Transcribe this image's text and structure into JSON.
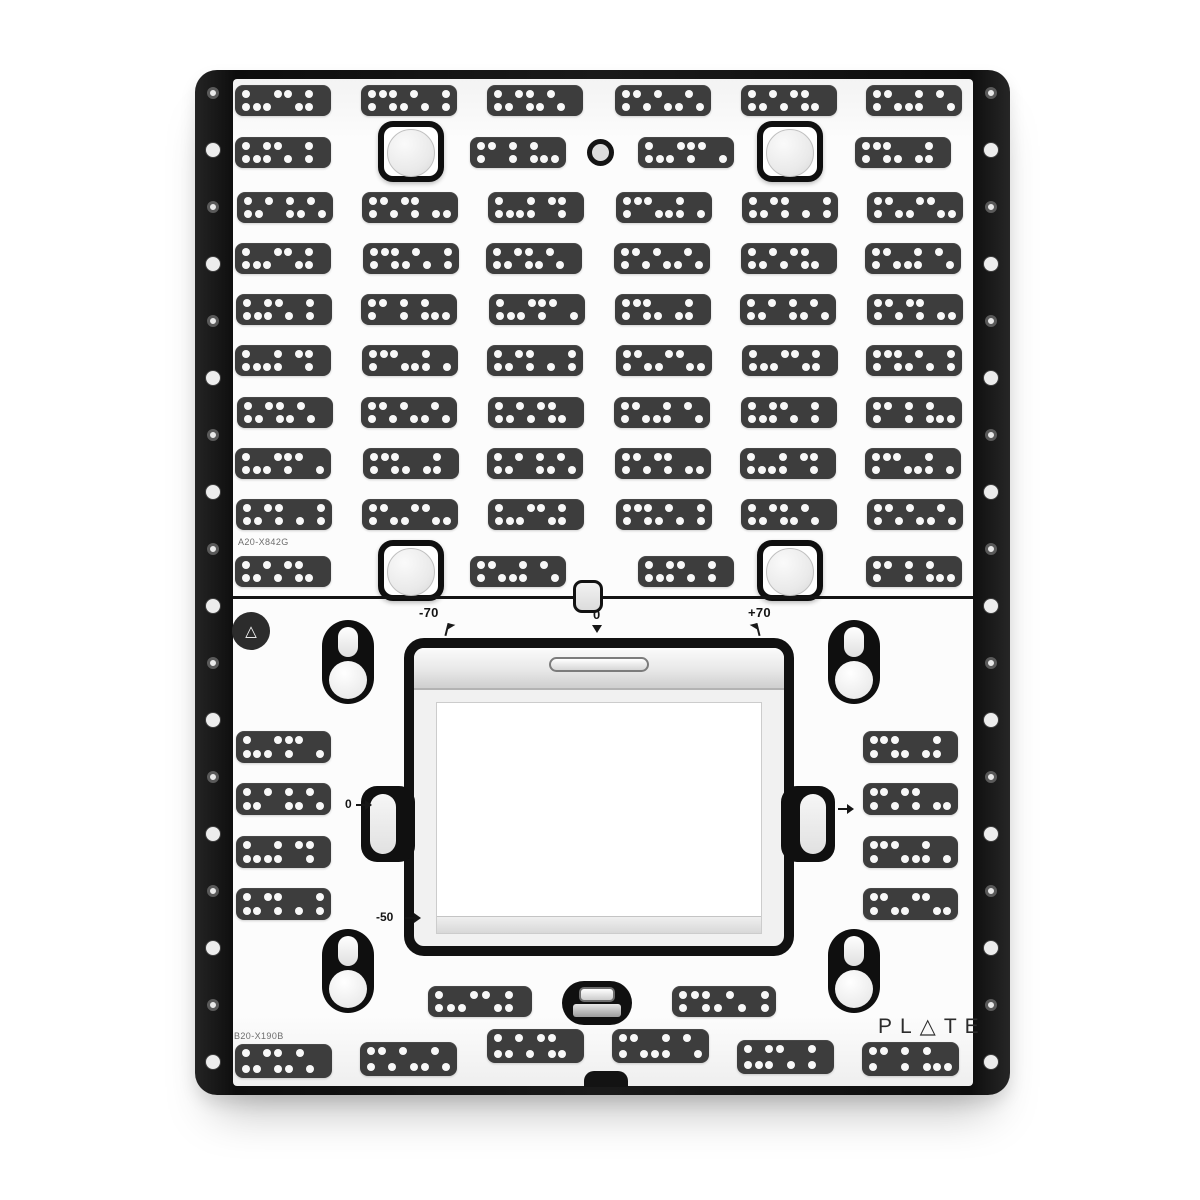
{
  "labels": {
    "logo_text": "PL△TE",
    "logo_reading": "PLATE",
    "part_number_upper": "A20-X842G",
    "part_number_lower": "B20-X190B",
    "tilt_scale": {
      "left": "-70",
      "center": "0",
      "right": "+70"
    },
    "height_scale": {
      "zero": "0",
      "minus_fifty": "-50"
    },
    "triangle_glyph": "△"
  },
  "colors": {
    "background": "#ffffff",
    "rail": "#141414",
    "face": "#fcfcfc",
    "pad": "#3d3d3d",
    "pad_dot": "#f8f8f8",
    "outline": "#111111",
    "label_text": "#151515",
    "part_text": "#6d6d6d",
    "brand_text": "#2c2c2c"
  },
  "pattern_pool": [
    "10011010|11100110",
    "11101001|10110101",
    "10110100|11011010",
    "11010010|10101101",
    "10101100|11010110",
    "11001010|10111001",
    "10110010|11101010",
    "11010100|10010111",
    "10011100|11101001",
    "11100010|10110110",
    "10101010|11001101",
    "11011000|10101011",
    "10010110|11110010",
    "11100100|10011101",
    "10110001|11010101",
    "11001100|10110011"
  ],
  "geometry": {
    "pad_size": {
      "w": 96,
      "h": 31
    },
    "top_grid_rows": [
      {
        "y": 85,
        "xs": [
          235,
          361,
          487,
          615,
          741,
          866
        ]
      },
      {
        "y": 137,
        "xs": [
          235,
          470,
          638,
          855
        ],
        "brackets_y": 121,
        "brackets_x": [
          378,
          757
        ],
        "ring_x": 587,
        "ring_y": 139
      },
      {
        "y": 192,
        "xs": [
          237,
          362,
          488,
          616,
          742,
          867
        ]
      },
      {
        "y": 243,
        "xs": [
          235,
          363,
          486,
          614,
          741,
          865
        ]
      },
      {
        "y": 294,
        "xs": [
          236,
          361,
          489,
          615,
          740,
          867
        ]
      },
      {
        "y": 345,
        "xs": [
          235,
          362,
          487,
          616,
          742,
          866
        ]
      },
      {
        "y": 397,
        "xs": [
          237,
          361,
          488,
          614,
          741,
          866
        ]
      },
      {
        "y": 448,
        "xs": [
          235,
          363,
          487,
          615,
          740,
          865
        ]
      },
      {
        "y": 499,
        "xs": [
          236,
          362,
          488,
          616,
          741,
          867
        ]
      },
      {
        "y": 556,
        "xs": [
          235,
          470,
          638,
          866
        ],
        "brackets_y": 540,
        "brackets_x": [
          378,
          757
        ]
      }
    ],
    "side_columns": {
      "ys": [
        731,
        783,
        836,
        888
      ],
      "left_x": 236,
      "right_x": 863,
      "w": 95,
      "h": 32
    },
    "bottom_mid_pads": [
      {
        "x": 428,
        "y": 986,
        "w": 104,
        "h": 31
      },
      {
        "x": 672,
        "y": 986,
        "w": 104,
        "h": 31
      }
    ],
    "bottom_row_pads": [
      {
        "x": 235,
        "y": 1044,
        "w": 97,
        "h": 34
      },
      {
        "x": 360,
        "y": 1042,
        "w": 97,
        "h": 34
      },
      {
        "x": 487,
        "y": 1029,
        "w": 97,
        "h": 34
      },
      {
        "x": 612,
        "y": 1029,
        "w": 97,
        "h": 34
      },
      {
        "x": 737,
        "y": 1040,
        "w": 97,
        "h": 34
      },
      {
        "x": 862,
        "y": 1042,
        "w": 97,
        "h": 34
      }
    ],
    "keyholes": [
      {
        "x": 322,
        "y": 620
      },
      {
        "x": 828,
        "y": 620
      },
      {
        "x": 322,
        "y": 929
      },
      {
        "x": 828,
        "y": 929
      }
    ],
    "rail_holes": {
      "start_y": 93,
      "spacing": 57,
      "count": 18,
      "left_center_x": 213,
      "right_center_x": 991
    }
  }
}
